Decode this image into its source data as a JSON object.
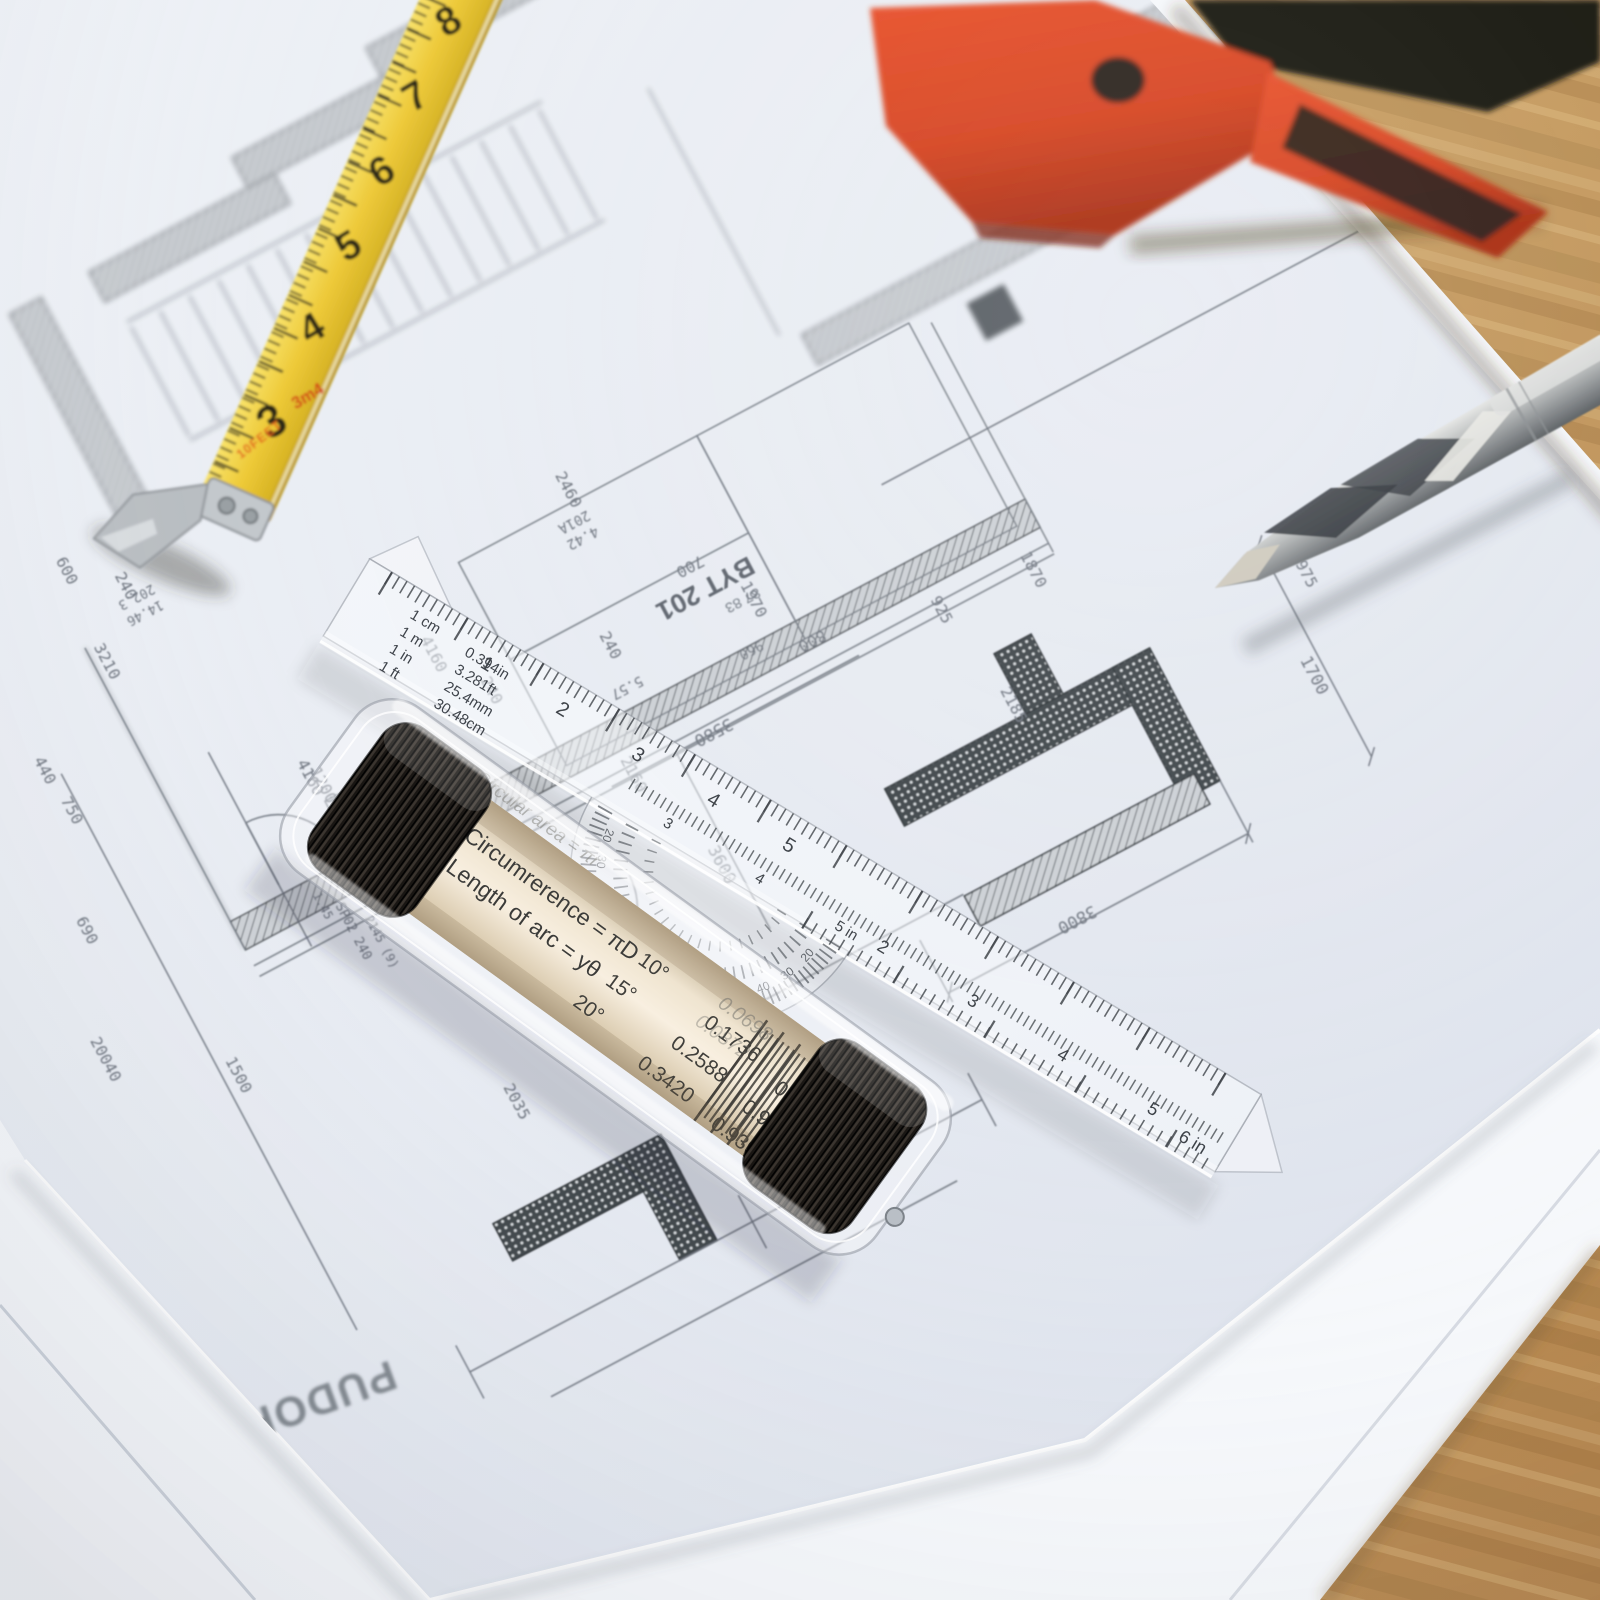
{
  "colors": {
    "paper": "#e9ecf2",
    "blueprint_line": "#767d86",
    "wall_dark": "#454b4e",
    "wood": "#c59a5e",
    "tape_yellow": "#edc93c",
    "knife_red": "#d6421f",
    "roller_cream": "#f2e7d3",
    "cap_black": "#191512",
    "metal_silver": "#b6b9ba"
  },
  "blueprint": {
    "title": "PUDORYS 2NP",
    "room_label": "BYT 201",
    "room_sub": "87 83",
    "dims": [
      "600",
      "240",
      "202.3",
      "14.46",
      "3210",
      "4160",
      "240",
      "1200",
      "440",
      "750",
      "690",
      "1.45",
      "SP02 240",
      "2145 (9)",
      "1500",
      "20040",
      "2460",
      "201A",
      "4.42",
      "700",
      "2160",
      "1970",
      "800",
      "1870",
      "5.57",
      "960",
      "925",
      "240",
      "3580",
      "3390",
      "3600",
      "3800",
      "1700",
      "1975",
      "2185",
      "2035",
      "1660",
      "4160"
    ]
  },
  "tape_measure": {
    "numbers": [
      "8",
      "7",
      "6",
      "5",
      "4",
      "3"
    ],
    "red_label": "3m4",
    "feet_label": "10FEET"
  },
  "ruler_tool": {
    "formulas": {
      "cover_area": "Circular area = πr",
      "circumference": "Circumrerence = πD",
      "arc_length": "Length of arc = yθ"
    },
    "trig_table": {
      "rows": [
        {
          "angle": "10°",
          "sin": "0.1736",
          "cos": "0.9848"
        },
        {
          "angle": "15°",
          "sin": "0.2588",
          "cos": "0.9659"
        },
        {
          "angle": "20°",
          "sin": "0.3420",
          "cos": "0.9397"
        }
      ],
      "overlay_values": [
        "0.0698",
        "0.0872",
        "0.9976",
        "0.9962"
      ]
    },
    "conversion_table": [
      {
        "from": "1 cm",
        "to": "0.394in"
      },
      {
        "from": "1 m",
        "to": "3.281ft"
      },
      {
        "from": "1 in",
        "to": "25.4mm"
      },
      {
        "from": "1 ft",
        "to": "30.48cm"
      }
    ],
    "protractor_degrees": [
      "20",
      "30",
      "40",
      "50",
      "60",
      "70",
      "80",
      "70",
      "60",
      "50",
      "40",
      "30",
      "20"
    ],
    "scales": {
      "top": [
        "1",
        "2",
        "3",
        "4",
        "5"
      ],
      "mid": [
        "3",
        "4"
      ],
      "mid_end": "5 in",
      "bottom": [
        "2",
        "3",
        "4",
        "5"
      ],
      "bottom_end": "6 in",
      "roller_mark": "2"
    }
  }
}
